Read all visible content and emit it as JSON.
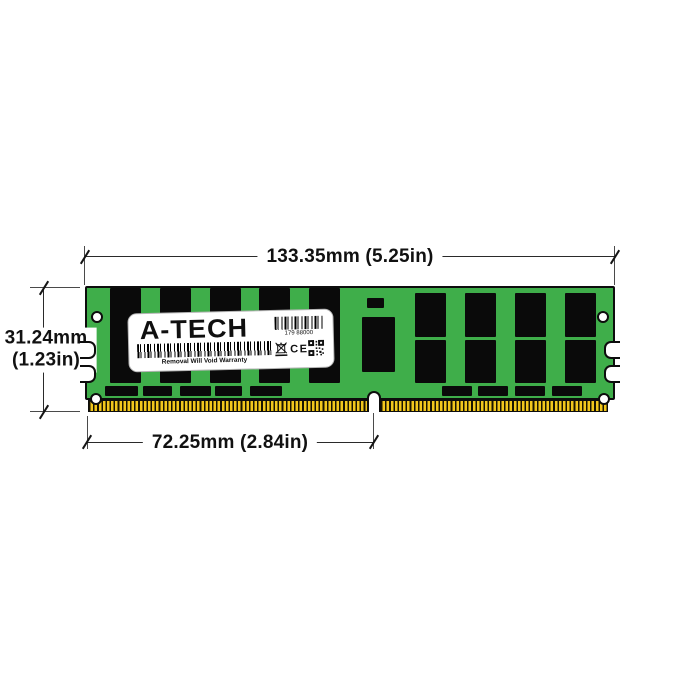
{
  "annotations": {
    "width_dim": "133.35mm (5.25in)",
    "height_dim_line1": "31.24mm",
    "height_dim_line2": "(1.23in)",
    "notch_dim": "72.25mm (2.84in)"
  },
  "module": {
    "label": {
      "brand": "A-TECH",
      "barcode_number": "179 88000",
      "warranty_text": "Removal Will Void Warranty",
      "ce_mark": "CE"
    },
    "icons": [
      "weee-crossed-bin-icon",
      "ce-mark",
      "qr-code-icon"
    ],
    "colors": {
      "pcb_green": "#3FAE4A",
      "chip_black": "#0A0A0A",
      "pin_gold": "#F2C71D",
      "line_dark": "#1A1A1A",
      "background": "#FFFFFF"
    }
  }
}
